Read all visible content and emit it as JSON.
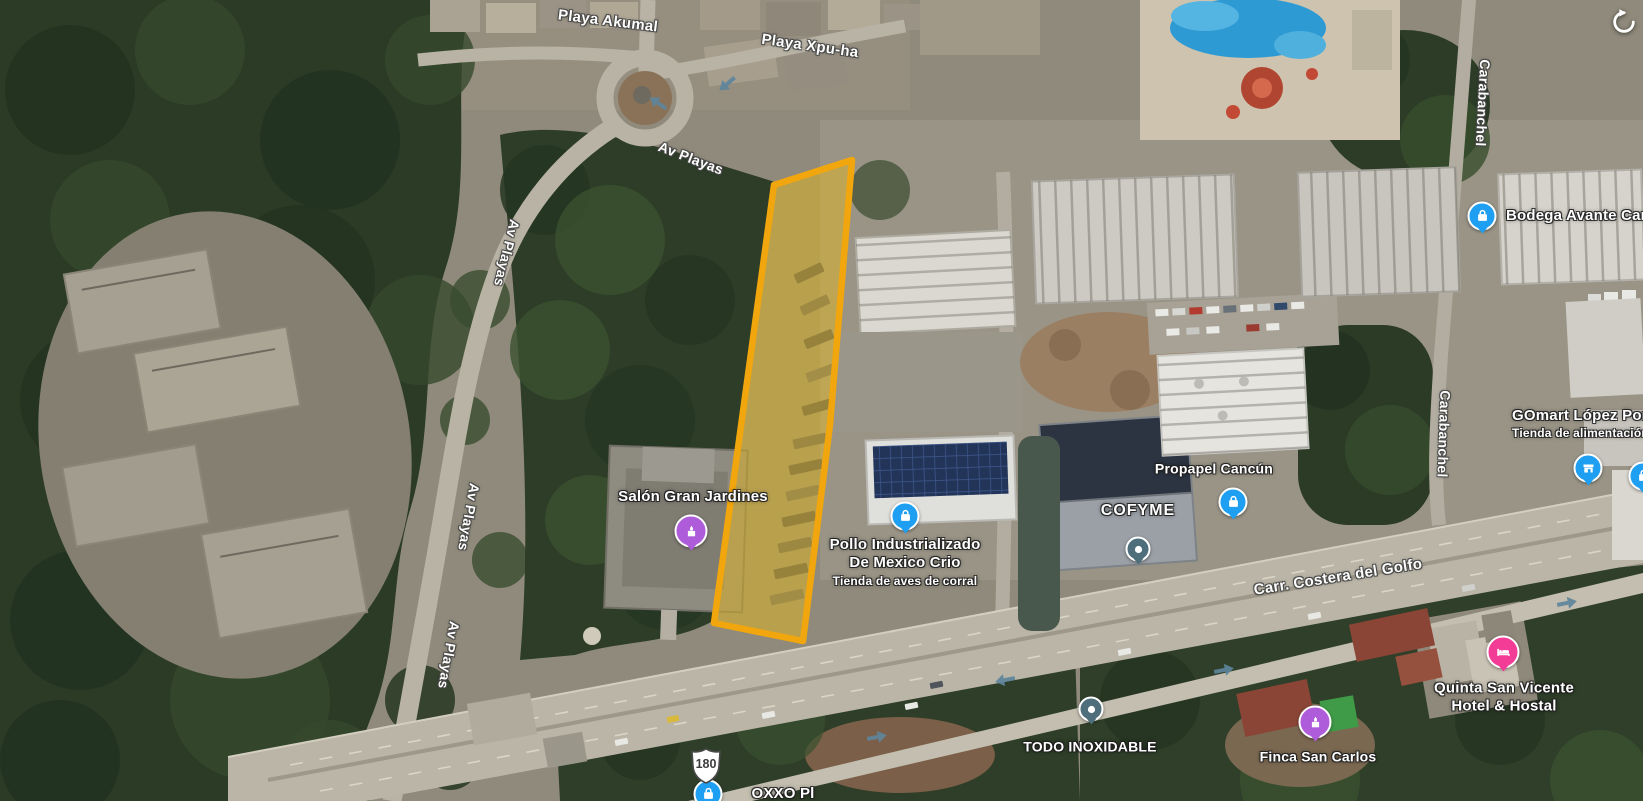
{
  "map_type": "satellite",
  "controls": {
    "reset_rotation_icon": "circular-arrow-counterclockwise"
  },
  "map": {
    "parcel_highlight": {
      "points": "774,185 852,160 830,425 803,641 714,623",
      "fill": "#E2B51F",
      "fill_opacity": 0.5,
      "stroke": "#F2A60D",
      "stroke_width": 6.5
    },
    "highway_shield": {
      "number": "180",
      "x": 706,
      "y": 766
    },
    "traffic_arrows": [
      {
        "x": 658,
        "y": 103,
        "rot": 215
      },
      {
        "x": 727,
        "y": 84,
        "rot": 140
      },
      {
        "x": 1005,
        "y": 680,
        "rot": 169
      },
      {
        "x": 1224,
        "y": 670,
        "rot": -11
      },
      {
        "x": 1567,
        "y": 603,
        "rot": -11
      },
      {
        "x": 877,
        "y": 737,
        "rot": -11
      }
    ]
  },
  "road_labels": [
    {
      "text": "Playa Akumal",
      "x": 608,
      "y": 21,
      "rot": 7,
      "size": 15
    },
    {
      "text": "Playa Xpu-ha",
      "x": 810,
      "y": 46,
      "rot": 8,
      "size": 15
    },
    {
      "text": "Av Playas",
      "x": 691,
      "y": 158,
      "rot": 21,
      "size": 14
    },
    {
      "text": "Av Playas",
      "x": 507,
      "y": 253,
      "rot": 104,
      "size": 14
    },
    {
      "text": "Av Playas",
      "x": 469,
      "y": 517,
      "rot": 100,
      "size": 14
    },
    {
      "text": "Av Playas",
      "x": 449,
      "y": 655,
      "rot": 100,
      "size": 14
    },
    {
      "text": "Carabanchel",
      "x": 1483,
      "y": 103,
      "rot": 93,
      "size": 14
    },
    {
      "text": "Carabanchel",
      "x": 1444,
      "y": 434,
      "rot": 92,
      "size": 14
    },
    {
      "text": "Carr. Costera del Golfo",
      "x": 1338,
      "y": 577,
      "rot": -9,
      "size": 15
    }
  ],
  "places": [
    {
      "id": "salon-gran-jardines",
      "lines": [
        "Salón Gran Jardines"
      ],
      "label": {
        "x": 693,
        "y": 497,
        "size": 15
      },
      "marker": {
        "type": "venue",
        "color": "#AE5CD9",
        "x": 691,
        "y": 531
      }
    },
    {
      "id": "pollo-industrializado",
      "lines": [
        "Pollo Industrializado",
        "De Mexico Crio"
      ],
      "subtitle": "Tienda de aves de corral",
      "label": {
        "x": 905,
        "y": 562,
        "size": 15
      },
      "marker": {
        "type": "store",
        "color": "#1E9FF2",
        "x": 905,
        "y": 516
      }
    },
    {
      "id": "cofyme",
      "lines": [
        "COFYME"
      ],
      "label": {
        "x": 1138,
        "y": 511,
        "size": 16,
        "spacing": 1
      },
      "marker": {
        "type": "generic",
        "color": "#4F6E7B",
        "x": 1138,
        "y": 549
      }
    },
    {
      "id": "propapel-cancun",
      "lines": [
        "Propapel Cancún"
      ],
      "label": {
        "x": 1214,
        "y": 469,
        "size": 14
      },
      "marker": {
        "type": "store",
        "color": "#1E9FF2",
        "x": 1233,
        "y": 502
      }
    },
    {
      "id": "bodega-avante",
      "lines": [
        "Bodega Avante Can"
      ],
      "label": {
        "x": 1506,
        "y": 216,
        "size": 15,
        "align": "left"
      },
      "marker": {
        "type": "store",
        "color": "#1E9FF2",
        "x": 1482,
        "y": 216
      }
    },
    {
      "id": "gomart-lopez",
      "lines": [
        "GOmart López Port"
      ],
      "subtitle": "Tienda de alimentación",
      "label": {
        "x": 1512,
        "y": 424,
        "size": 15,
        "align": "left"
      },
      "marker": {
        "type": "shop",
        "color": "#1E9FF2",
        "x": 1588,
        "y": 468
      }
    },
    {
      "id": "todo-inoxidable",
      "lines": [
        "TODO INOXIDABLE"
      ],
      "label": {
        "x": 1090,
        "y": 747,
        "size": 14
      },
      "marker": {
        "type": "generic",
        "color": "#4F6E7B",
        "x": 1091,
        "y": 709
      }
    },
    {
      "id": "quinta-san-vicente",
      "lines": [
        "Quinta San Vicente",
        "Hotel & Hostal"
      ],
      "label": {
        "x": 1504,
        "y": 698,
        "size": 15
      },
      "marker": {
        "type": "hotel",
        "color": "#F23C96",
        "x": 1503,
        "y": 652
      }
    },
    {
      "id": "finca-san-carlos",
      "lines": [
        "Finca San Carlos"
      ],
      "label": {
        "x": 1318,
        "y": 757,
        "size": 14
      },
      "marker": {
        "type": "venue",
        "color": "#AE5CD9",
        "x": 1315,
        "y": 722
      }
    },
    {
      "id": "oxxo",
      "lines": [
        "OXXO Pl"
      ],
      "label": {
        "x": 783,
        "y": 794,
        "size": 15
      },
      "marker": {
        "type": "store",
        "color": "#1E9FF2",
        "x": 708,
        "y": 794
      }
    }
  ],
  "edge_markers": [
    {
      "type": "store",
      "color": "#1E9FF2",
      "x": 1643,
      "y": 476
    }
  ]
}
